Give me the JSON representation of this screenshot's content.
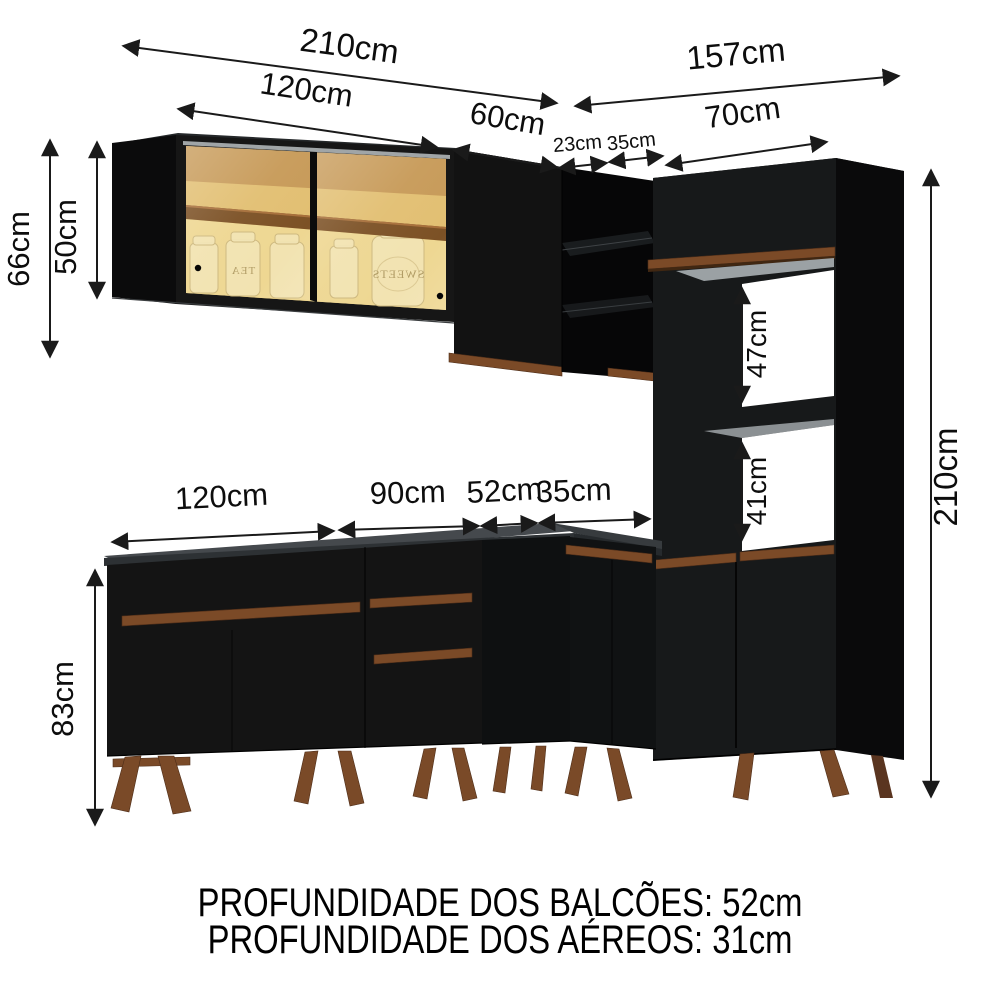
{
  "diagram_title": "kitchen-cabinet-dimension-diagram",
  "dims": {
    "top_210": "210cm",
    "top_157": "157cm",
    "top_120": "120cm",
    "top_60": "60cm",
    "top_23": "23cm",
    "top_35": "35cm",
    "top_70": "70cm",
    "left_66": "66cm",
    "left_50": "50cm",
    "niche_47": "47cm",
    "niche_41": "41cm",
    "right_210": "210cm",
    "bottom_120": "120cm",
    "bottom_90": "90cm",
    "bottom_52": "52cm",
    "bottom_35": "35cm",
    "base_83": "83cm"
  },
  "footer": {
    "line1": "PROFUNDIDADE DOS BALCÕES: 52cm",
    "line2": "PROFUNDIDADE DOS AÉREOS: 31cm"
  },
  "jars": {
    "tea": "TEA",
    "sweets": "SWEETS"
  },
  "colors": {
    "cabinet_black": "#141414",
    "cabinet_side_black": "#0a0a0b",
    "wood_brown": "#7b4a27",
    "glass_amber": "#e2bf72",
    "interior_shelf_brown": "#7c5125",
    "counter_gray": "#45494d",
    "niche_white": "#ffffff",
    "dimension_line": "#1a1a1a"
  }
}
